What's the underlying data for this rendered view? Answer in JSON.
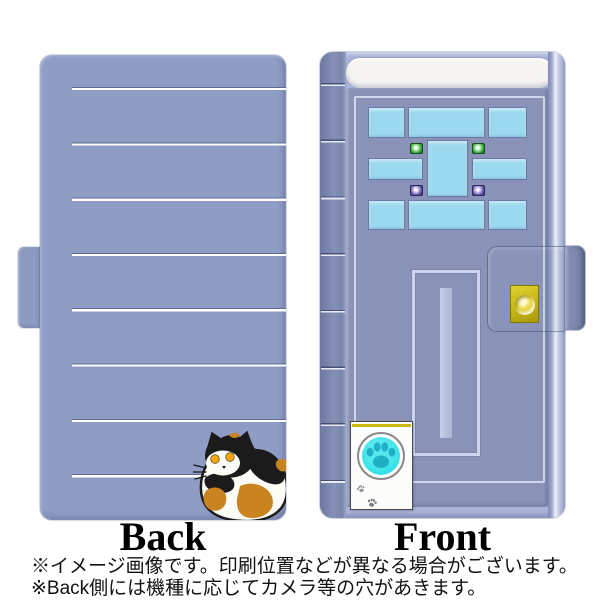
{
  "product": {
    "views": [
      {
        "id": "back",
        "label": "Back"
      },
      {
        "id": "front",
        "label": "Front"
      }
    ],
    "notes": [
      "※イメージ画像です。印刷位置などが異なる場合がございます。",
      "※Back側には機種に応じてカメラ等の穴があきます。"
    ]
  },
  "design": {
    "back_cover": {
      "motif": "calico-cat",
      "stripe_count": 8
    },
    "front_cover": {
      "motif": "door",
      "elements": [
        "window-panes",
        "green-studs",
        "purple-studs",
        "mail-slot",
        "gold-keyhole",
        "pet-door",
        "paw-print"
      ]
    }
  },
  "colors": {
    "background": "#ffffff",
    "case_back": "#8f9dc5",
    "case_rim": "#aab4da",
    "spine": "#7e89ae",
    "door_panel": "#8a93b7",
    "stripe": "#ffffff",
    "window_glass": "#9bd9ef",
    "stud_green": "#2f9a35",
    "stud_purple": "#5a4f9e",
    "lock_gold": "#cbbb18",
    "pet_door": "#fcfcfa",
    "paw_circle_cyan": "#35e0e8",
    "paw_print_teal": "#1fb0c6",
    "cat_black": "#1b1b1b",
    "cat_white": "#fdfdf8",
    "cat_orange": "#c9841f",
    "cat_eye_amber": "#f3a70b"
  }
}
